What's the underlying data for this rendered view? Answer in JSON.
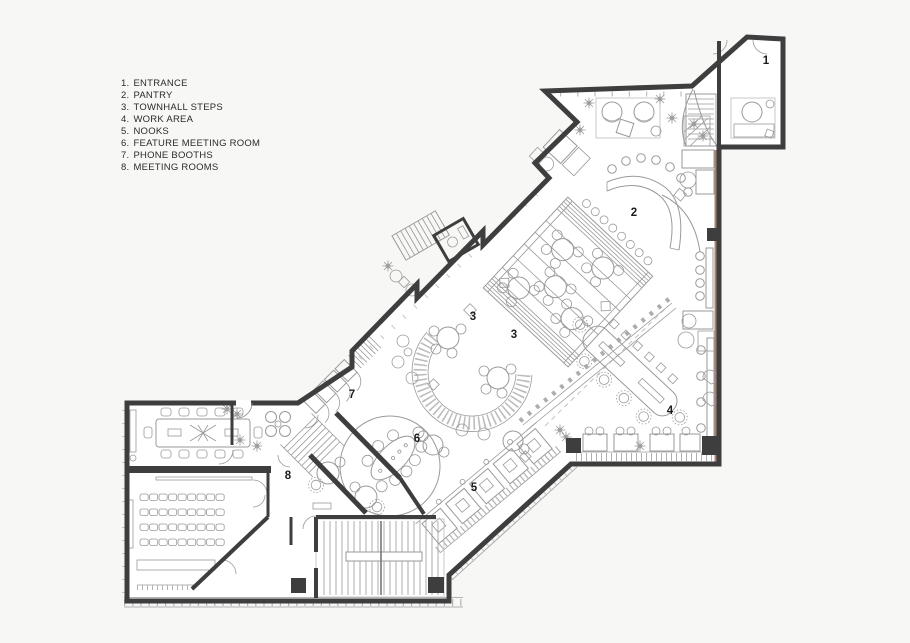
{
  "page": {
    "background": "#f7f7f5"
  },
  "legend": {
    "items": [
      {
        "number": "1.",
        "label": "ENTRANCE"
      },
      {
        "number": "2.",
        "label": "PANTRY"
      },
      {
        "number": "3.",
        "label": "TOWNHALL STEPS"
      },
      {
        "number": "4.",
        "label": "WORK AREA"
      },
      {
        "number": "5.",
        "label": "NOOKS"
      },
      {
        "number": "6.",
        "label": "FEATURE MEETING ROOM"
      },
      {
        "number": "7.",
        "label": "PHONE BOOTHS"
      },
      {
        "number": "8.",
        "label": "MEETING ROOMS"
      }
    ]
  },
  "plan": {
    "colors": {
      "wall": "#3e3e3e",
      "line": "#9a9a9a",
      "label": "#1c1c1c",
      "accent": "#9b6c57"
    },
    "room_labels": [
      {
        "number": "1",
        "x": 766,
        "y": 64
      },
      {
        "number": "2",
        "x": 634,
        "y": 216
      },
      {
        "number": "3",
        "x": 473,
        "y": 320
      },
      {
        "number": "3",
        "x": 514,
        "y": 338
      },
      {
        "number": "4",
        "x": 670,
        "y": 414
      },
      {
        "number": "5",
        "x": 474,
        "y": 491
      },
      {
        "number": "6",
        "x": 417,
        "y": 442
      },
      {
        "number": "7",
        "x": 352,
        "y": 398
      },
      {
        "number": "8",
        "x": 288,
        "y": 479
      }
    ]
  }
}
